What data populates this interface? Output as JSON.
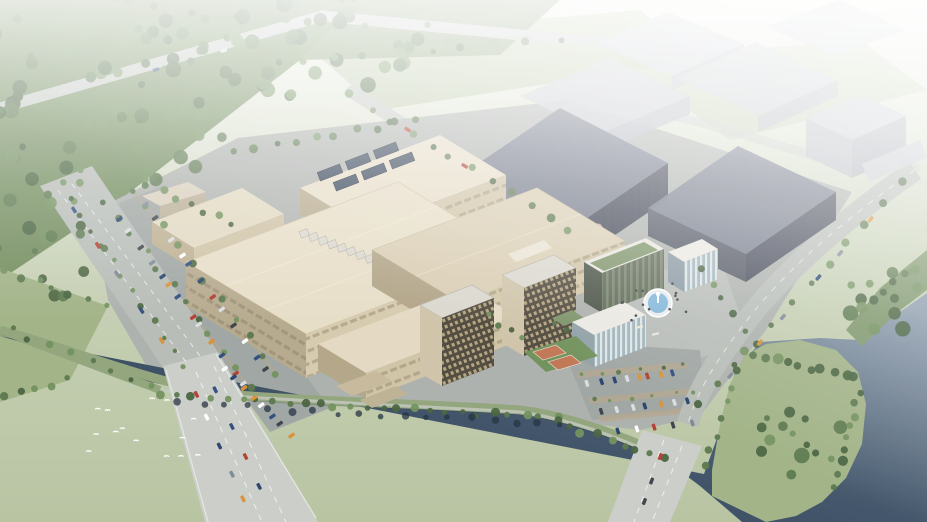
{
  "meta": {
    "title": "Aerial architectural rendering of a riverside industrial campus",
    "style": "photorealistic masterplan bird's-eye view, hazy daylight",
    "dimensions": "927x522"
  },
  "colors": {
    "haze": "#ffffff",
    "field_green": "#c2cdb0",
    "field_light": "#eff2e9",
    "forest_green": "#6f8a5a",
    "grass_light": "#9fb184",
    "tree_dark": "#44603c",
    "tree_mid": "#567449",
    "tree_light": "#6f8e5a",
    "blossom": "#d4a4b4",
    "reflection": "#1f2e3c",
    "water_dark": "#22334a",
    "water_mid": "#3d5166",
    "water_light": "#8a9aab",
    "road": "#b6bbb6",
    "bridge": "#c9cdc7",
    "ground": "#abafab",
    "plaza": "#b7bbb7",
    "parking": "#9ea4a1",
    "median_tan": "#b3a489",
    "cream_roof": "#e7ddc6",
    "cream_roof_shade": "#d9cdb2",
    "cream_wall": "#d6c9ac",
    "cream_wall_shade": "#b5a88b",
    "warehouse_roof": "#6f7585",
    "warehouse_wall": "#474c59",
    "warehouse_wall_dark": "#3c4150",
    "solar": "#2f3e53",
    "context": "#c6c9d0",
    "dorm_wall": "#4e463a",
    "dorm_end": "#cfc3a8",
    "roof_white": "#ebe9e2",
    "glass_green": "#5b6553",
    "glass_blue": "#9fb3bb",
    "terrace_green": "#7b9166",
    "court_green": "#6e8f58",
    "court_orange": "#bf7350",
    "fountain_water": "#7fb6d9",
    "unit_gray": "#dad7ce"
  },
  "scene": {
    "environment": [
      "dense forest northwest",
      "hazy fields north",
      "dark river across foreground",
      "white atmospheric haze toward top right"
    ],
    "buildings": [
      {
        "id": "annex-hall",
        "type": "small factory annex, cream"
      },
      {
        "id": "hall-b",
        "type": "factory hall with rooftop solar array"
      },
      {
        "id": "hall-a",
        "type": "main factory hall with rooftop cooling units"
      },
      {
        "id": "high-bay-hall",
        "type": "high-bay production hall, light roof"
      },
      {
        "id": "hall-se",
        "type": "low production wing"
      },
      {
        "id": "warehouse-1",
        "type": "large dark logistics warehouse"
      },
      {
        "id": "warehouse-2",
        "type": "dark logistics warehouse"
      },
      {
        "id": "dorm-tower-1",
        "type": "mid-rise dormitory tower, dark window grid"
      },
      {
        "id": "dorm-tower-2",
        "type": "mid-rise dormitory tower, dark window grid"
      },
      {
        "id": "office-slab",
        "type": "office building with roof garden"
      },
      {
        "id": "office-cube",
        "type": "small office block, white roof"
      },
      {
        "id": "canteen",
        "type": "amenity building, white roof, glass facade"
      },
      {
        "id": "gatehouse",
        "type": "gatehouse at northwest entrance"
      },
      {
        "id": "substation",
        "type": "electrical substation yard"
      },
      {
        "id": "context-buildings",
        "type": "hazy background buildings",
        "count": 7
      }
    ],
    "site_features": [
      "entry plaza with circular fountain",
      "two basketball courts",
      "west surface parking rows",
      "southeast surface parking rows",
      "sky bridge between halls",
      "riverside promenade with tree row",
      "tree-covered park peninsula"
    ],
    "infrastructure": {
      "bridges": [
        {
          "id": "bridge-southwest"
        },
        {
          "id": "bridge-southeast"
        }
      ],
      "roads": [
        "west arterial with tree median",
        "northwest forest road",
        "north access road",
        "east riverside road"
      ]
    },
    "wildlife": {
      "birds_over_water": 14
    },
    "vehicles": {
      "approx_count": 80,
      "palette": [
        "#ffffff",
        "#d9dde0",
        "#2c4a7c",
        "#24406b",
        "#b23b2e",
        "#3a3f47",
        "#d98f33",
        "#7a8794"
      ]
    },
    "counts": {
      "rooftop_units": 8,
      "solar_panels": 6,
      "plaza_people": 14
    }
  }
}
